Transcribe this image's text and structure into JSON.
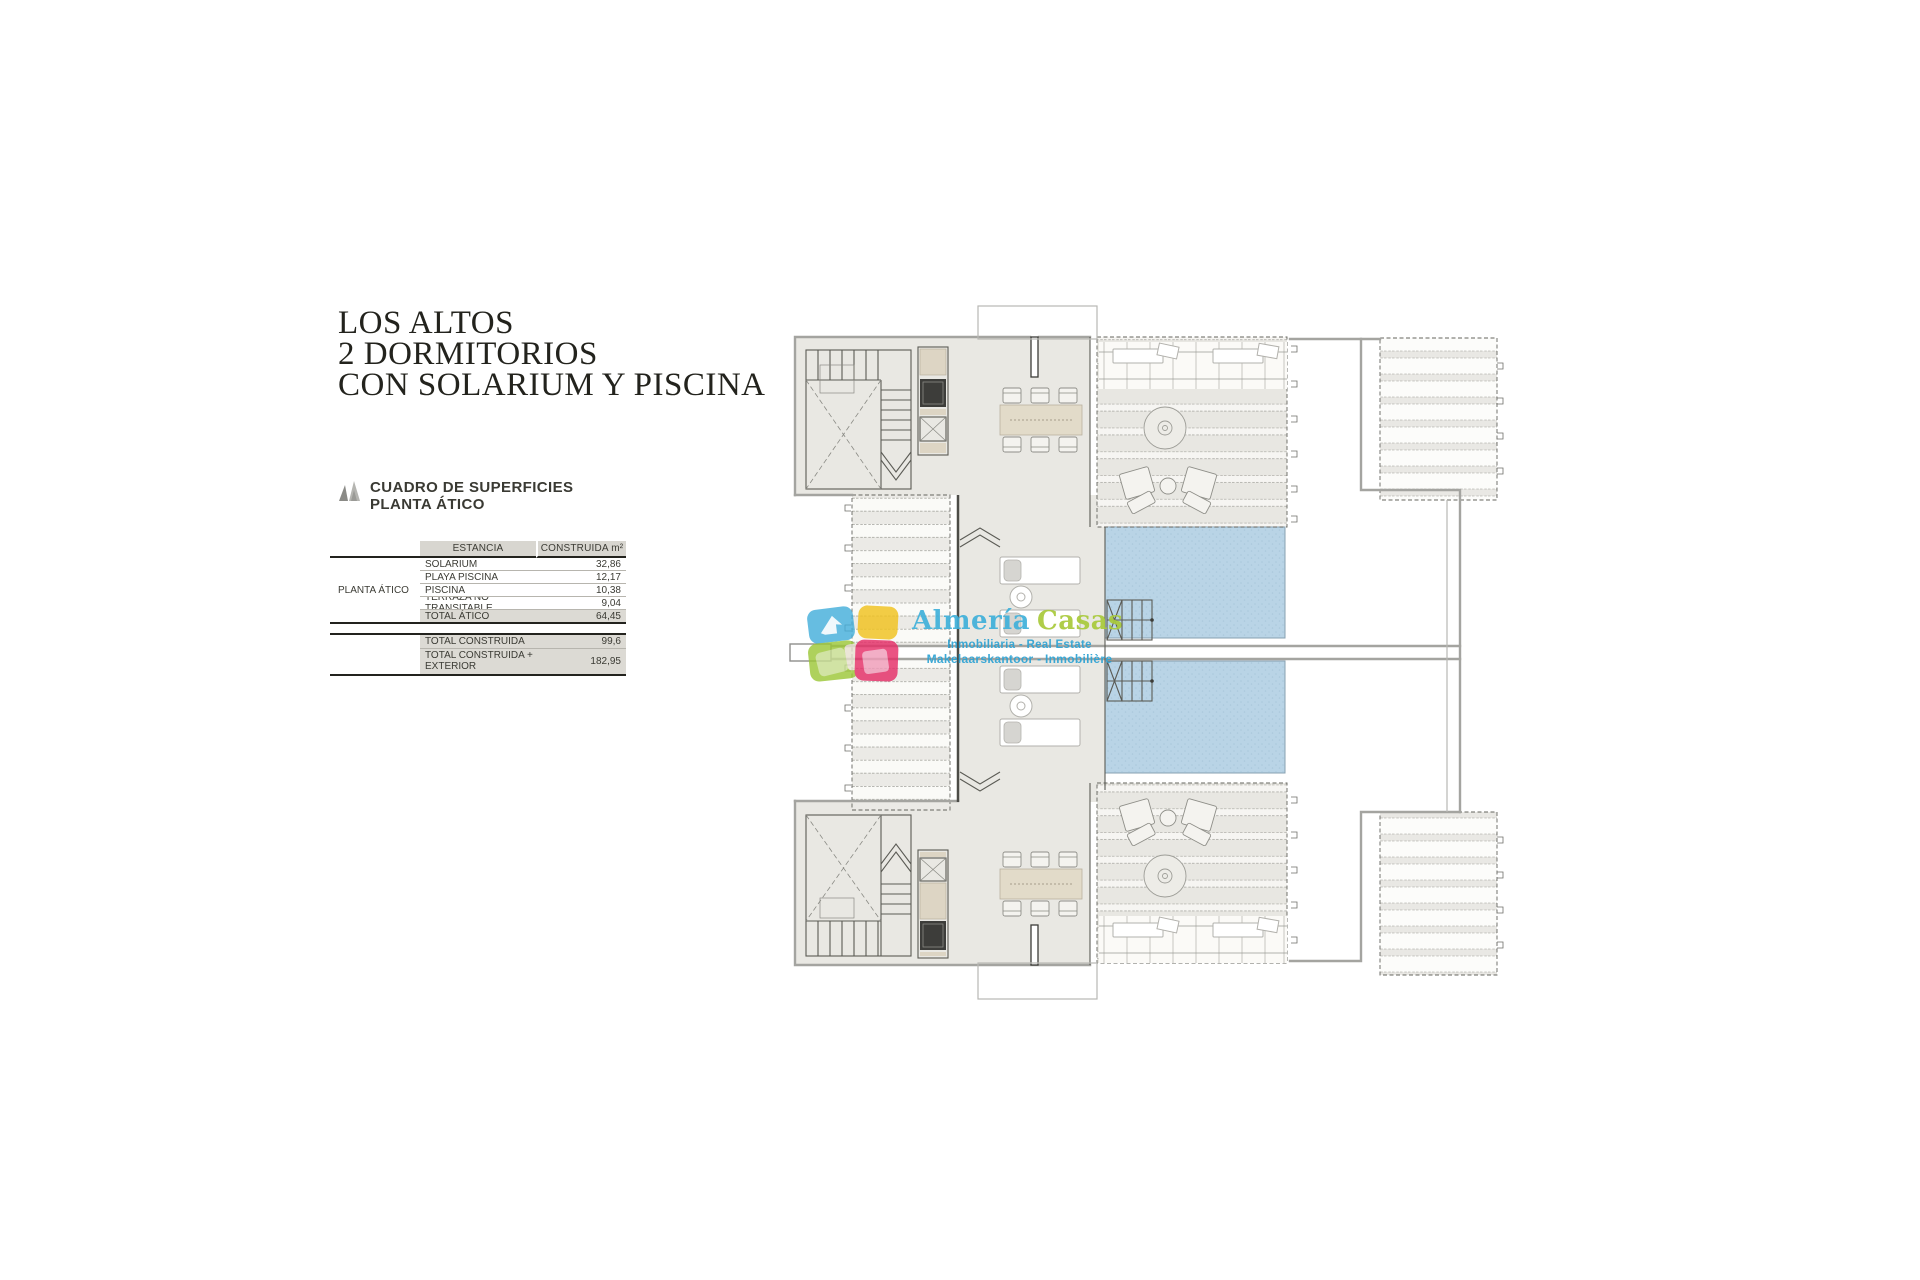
{
  "title": {
    "line1": "LOS ALTOS",
    "line2": "2 DORMITORIOS",
    "line3": "CON SOLARIUM Y PISCINA"
  },
  "surfaces": {
    "heading_line1": "CUADRO DE SUPERFICIES",
    "heading_line2": "PLANTA ÁTICO",
    "table": {
      "group_label": "PLANTA ÁTICO",
      "col_estancia": "ESTANCIA",
      "col_construida": "CONSTRUIDA m²",
      "rows": [
        {
          "label": "SOLARIUM",
          "value": "32,86"
        },
        {
          "label": "PLAYA PISCINA",
          "value": "12,17"
        },
        {
          "label": "PISCINA",
          "value": "10,38"
        },
        {
          "label": "TERRAZA NO TRANSITABLE",
          "value": "9,04"
        },
        {
          "label": "TOTAL ÁTICO",
          "value": "64,45"
        }
      ],
      "totals": [
        {
          "label": "TOTAL CONSTRUIDA",
          "value": "99,6"
        },
        {
          "label": "TOTAL CONSTRUIDA + EXTERIOR",
          "value": "182,95"
        }
      ]
    }
  },
  "watermark": {
    "brand_primary": "Almería",
    "brand_secondary": "Casas",
    "tagline1": "Inmobiliaria - Real Estate",
    "tagline2": "Makelaarskantoor - Inmobilière",
    "colors": {
      "blue": "#45b0db",
      "yellow": "#f2c31e",
      "green": "#9cc838",
      "pink": "#e62e68",
      "brand_blue": "#41b1da",
      "brand_green": "#a9ca3c"
    }
  },
  "plan": {
    "pool_color": "#b9d4e6"
  }
}
